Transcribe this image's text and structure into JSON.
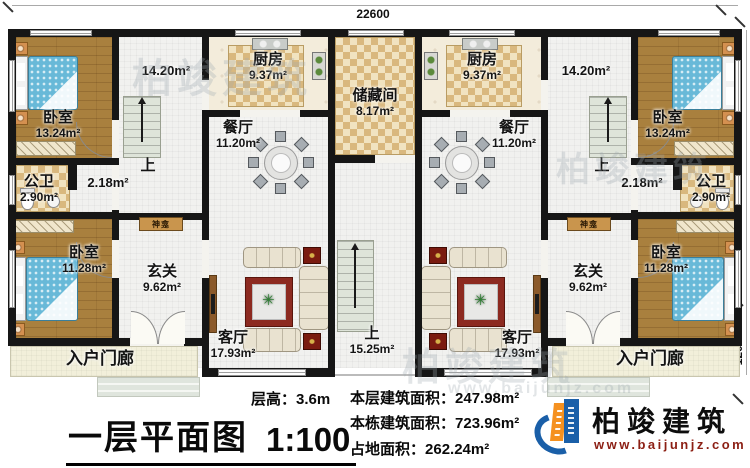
{
  "plan": {
    "dimensions": {
      "width_top": "22600",
      "height_right": "9800",
      "porch_right": "1200"
    },
    "stair_up": "上",
    "shrine_label": "神龛",
    "rooms": {
      "bedroom_top": {
        "name": "卧室",
        "area": "13.24m²"
      },
      "bedroom_bottom": {
        "name": "卧室",
        "area": "11.28m²"
      },
      "kitchen": {
        "name": "厨房",
        "area": "9.37m²"
      },
      "dining": {
        "name": "餐厅",
        "area": "11.20m²"
      },
      "storage": {
        "name": "储藏间",
        "area": "8.17m²"
      },
      "bath": {
        "name": "公卫",
        "area": "2.90m²"
      },
      "hall": {
        "area": "14.20m²"
      },
      "corridor": {
        "area": "2.18m²"
      },
      "foyer": {
        "name": "玄关",
        "area": "9.62m²"
      },
      "living": {
        "name": "客厅",
        "area": "17.93m²"
      },
      "stairs_center": {
        "name": "上",
        "area": "15.25m²"
      },
      "porch": {
        "name": "入户门廊"
      }
    }
  },
  "watermark": {
    "text": "柏竣建筑",
    "url": "www.baijunjz.com"
  },
  "footer": {
    "title": "一层平面图",
    "scale": "1:100",
    "floor_height": {
      "label": "层高：",
      "value": "3.6m"
    },
    "stats": [
      {
        "label": "本层建筑面积：",
        "value": "247.98m²"
      },
      {
        "label": "本栋建筑面积：",
        "value": "723.96m²"
      },
      {
        "label": "占地面积：",
        "value": "262.24m²"
      }
    ],
    "logo": {
      "name": "柏竣建筑",
      "url": "www.baijunjz.com"
    },
    "accent_blue": "#1a5fa8",
    "accent_orange": "#f59120"
  }
}
